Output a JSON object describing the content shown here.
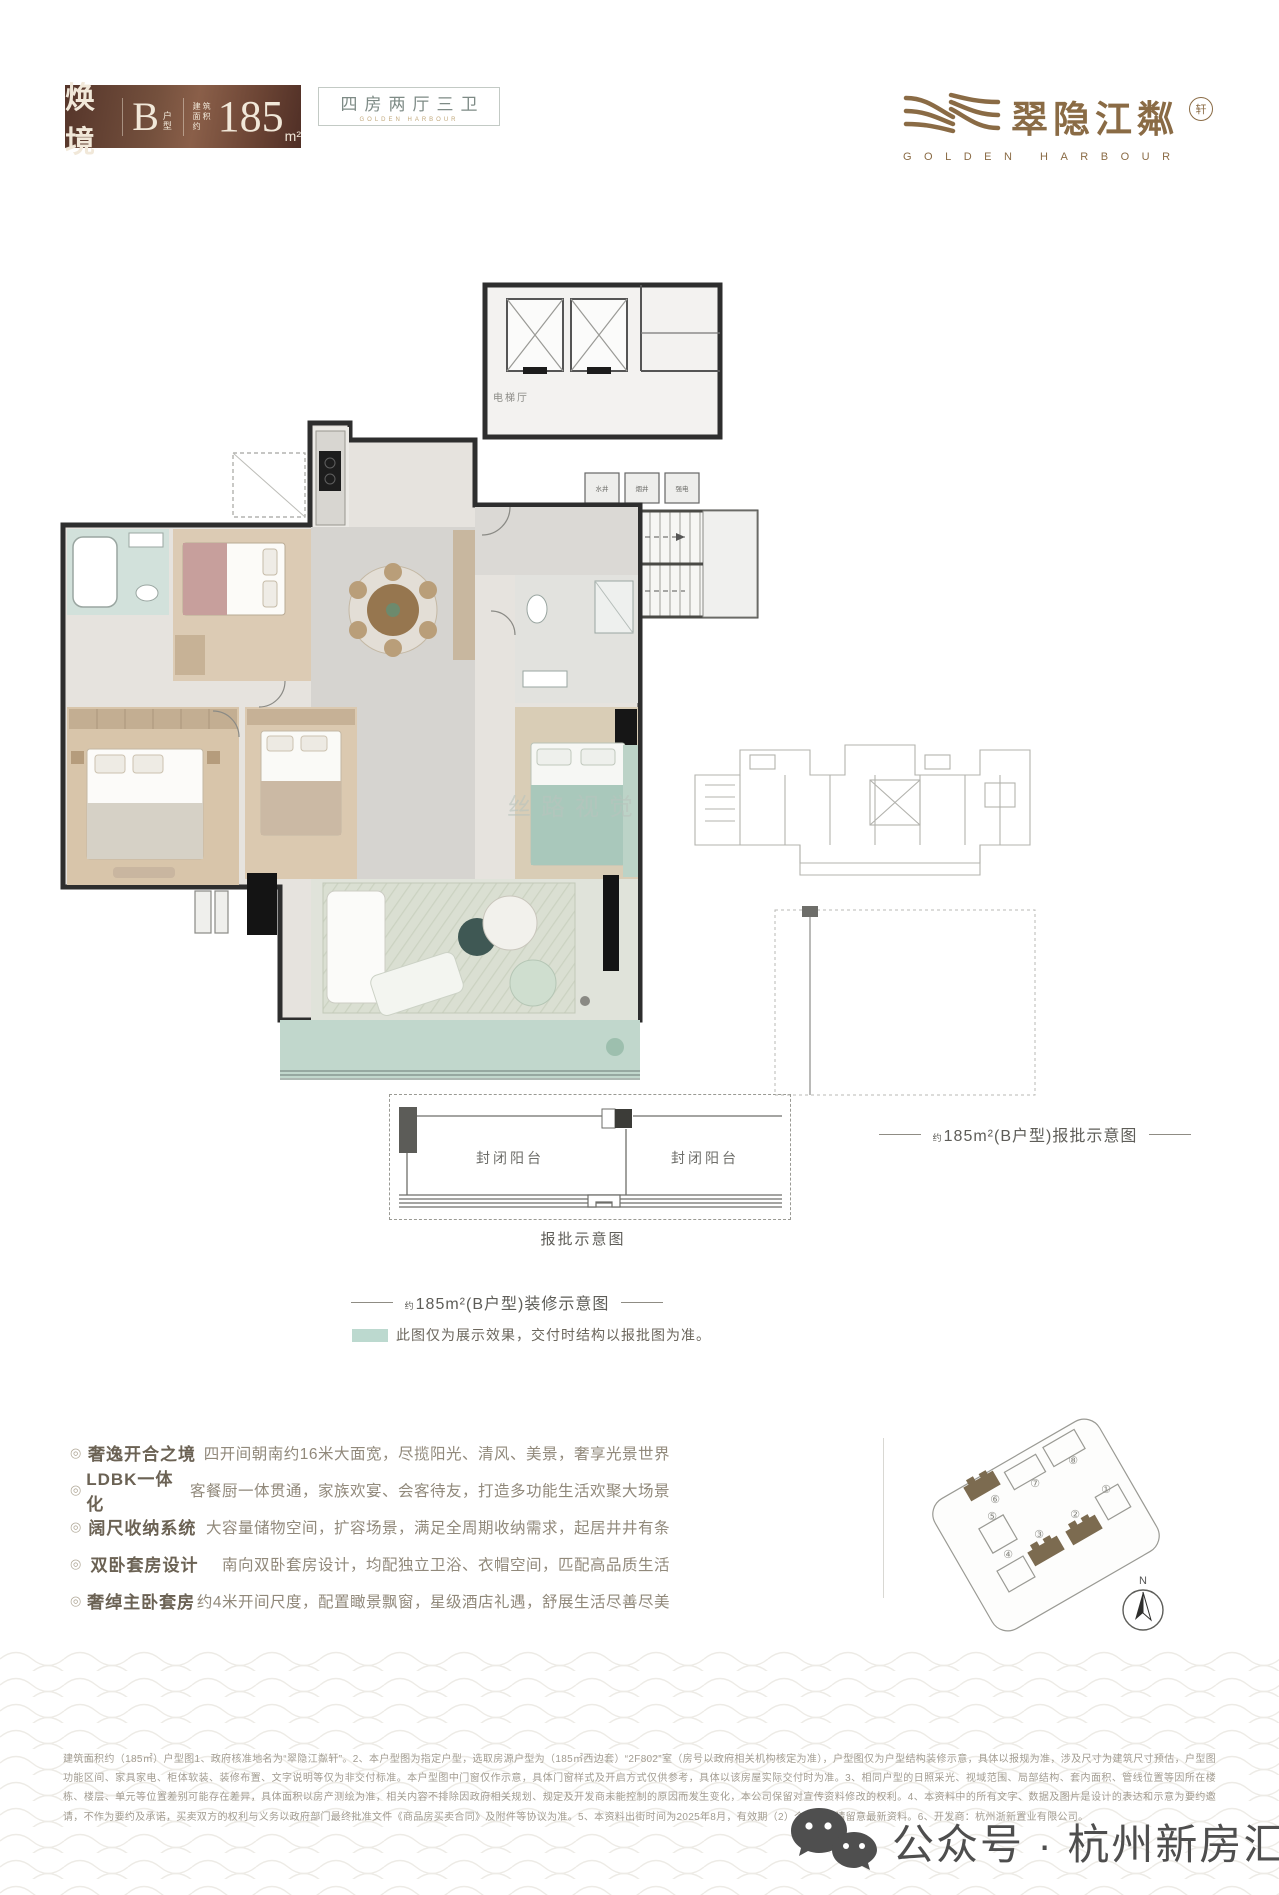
{
  "header": {
    "badge": {
      "series": "焕境",
      "type_letter": "B",
      "type_label": "户型",
      "area_prefix_1": "建筑",
      "area_prefix_2": "面积约",
      "area_value": "185",
      "area_unit": "m²"
    },
    "rooms_box": {
      "label": "四房两厅三卫",
      "sub_label": "GOLDEN HARBOUR"
    },
    "logo": {
      "cn": "翠隐江粼",
      "seal": "轩",
      "en": "GOLDEN HARBOUR"
    }
  },
  "plan": {
    "elevator_hall": "电梯厅",
    "shafts": [
      "水井",
      "烟井",
      "强电"
    ],
    "watermark": "丝路视觉"
  },
  "approval_inset": {
    "balcony": "封闭阳台",
    "caption": "报批示意图"
  },
  "captions": {
    "prefix": "约",
    "decor": "185m²(B户型)装修示意图",
    "approval": "185m²(B户型)报批示意图"
  },
  "legend": {
    "text": "此图仅为展示效果，交付时结构以报批图为准。"
  },
  "features": {
    "bullet": "◎",
    "items": [
      {
        "label": "奢逸开合之境",
        "desc": "四开间朝南约16米大面宽，尽揽阳光、清风、美景，奢享光景世界"
      },
      {
        "label": "LDBK一体化",
        "desc": "客餐厨一体贯通，家族欢宴、会客待友，打造多功能生活欢聚大场景"
      },
      {
        "label": "阔尺收纳系统",
        "desc": "大容量储物空间，扩容场景，满足全周期收纳需求，起居井井有条"
      },
      {
        "label": "双卧套房设计",
        "desc": "南向双卧套房设计，均配独立卫浴、衣帽空间，匹配高品质生活"
      },
      {
        "label": "奢绰主卧套房",
        "desc": "约4米开间尺度，配置瞰景飘窗，星级酒店礼遇，舒展生活尽善尽美"
      }
    ]
  },
  "site_plan": {
    "north": "N",
    "buildings": [
      {
        "num": "⑥",
        "filled": true
      },
      {
        "num": "⑦",
        "filled": false
      },
      {
        "num": "⑧",
        "filled": false
      },
      {
        "num": "⑤",
        "filled": false
      },
      {
        "num": "③",
        "filled": true
      },
      {
        "num": "②",
        "filled": true
      },
      {
        "num": "①",
        "filled": false
      },
      {
        "num": "④",
        "filled": false
      }
    ],
    "accent_color": "#7c6b50"
  },
  "footer": {
    "disclaimer": "建筑面积约（185㎡）户型图1、政府核准地名为“翠隐江粼轩”。2、本户型图为指定户型，选取房源户型为（185㎡西边套）“2F802”室（房号以政府相关机构核定为准），户型图仅为户型结构装修示意，具体以报规为准，涉及尺寸为建筑尺寸预估，户型图功能区间、家具家电、柜体软装、装修布置、文字说明等仅为非交付标准。本户型图中门窗仅作示意，具体门窗样式及开启方式仅供参考，具体以该房屋实际交付时为准。3、相同户型的日照采光、视域范围、局部结构、套内面积、管线位置等因所在楼栋、楼层、单元等位置差别可能存在差异，具体面积以房产测绘为准，相关内容不排除因政府相关规划、规定及开发商未能控制的原因而发生变化，本公司保留对宣传资料修改的权利。4、本资料中的所有文字、数据及图片是设计的表达和示意为要约邀请，不作为要约及承诺，买卖双方的权利与义务以政府部门最终批准文件《商品房买卖合同》及附件等协议为准。5、本资料出街时间为2025年8月，有效期（2）个月，敬请留意最新资料。6、开发商：杭州浙新置业有限公司。",
    "wechat": "公众号 · 杭州新房汇"
  }
}
